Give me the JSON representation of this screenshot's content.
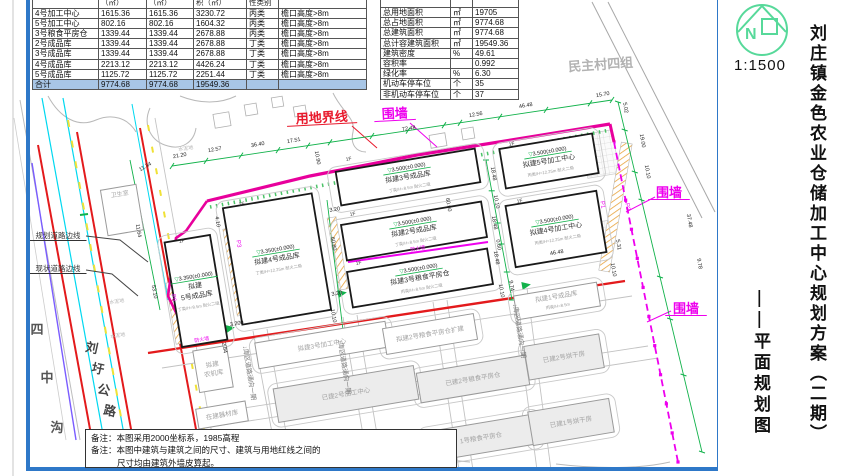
{
  "left_table": {
    "header_fragments": [
      "",
      "（㎡）",
      "（㎡）",
      "积（㎡）",
      "性类别",
      ""
    ],
    "col_widths": [
      66,
      48,
      47,
      53,
      32,
      88
    ],
    "rows": [
      {
        "name": "4号加工中心",
        "a1": "1615.36",
        "a2": "1615.36",
        "a3": "3230.72",
        "cls": "丙类",
        "note": "檐口高度>8m"
      },
      {
        "name": "5号加工中心",
        "a1": "802.16",
        "a2": "802.16",
        "a3": "1604.32",
        "cls": "丙类",
        "note": "檐口高度>8m"
      },
      {
        "name": "3号粮食平房仓",
        "a1": "1339.44",
        "a2": "1339.44",
        "a3": "2678.88",
        "cls": "丙类",
        "note": "檐口高度>8m"
      },
      {
        "name": "2号成品库",
        "a1": "1339.44",
        "a2": "1339.44",
        "a3": "2678.88",
        "cls": "丁类",
        "note": "檐口高度>8m"
      },
      {
        "name": "3号成品库",
        "a1": "1339.44",
        "a2": "1339.44",
        "a3": "2678.88",
        "cls": "丁类",
        "note": "檐口高度>8m"
      },
      {
        "name": "4号成品库",
        "a1": "2213.12",
        "a2": "2213.12",
        "a3": "4426.24",
        "cls": "丁类",
        "note": "檐口高度>8m"
      },
      {
        "name": "5号成品库",
        "a1": "1125.72",
        "a2": "1125.72",
        "a3": "2251.44",
        "cls": "丁类",
        "note": "檐口高度>8m"
      }
    ],
    "total": {
      "name": "合计",
      "a1": "9774.68",
      "a2": "9774.68",
      "a3": "19549.36",
      "cls": "",
      "note": ""
    }
  },
  "right_table": {
    "col_widths": [
      70,
      22,
      46
    ],
    "rows": [
      {
        "name": "总用地面积",
        "unit": "㎡",
        "value": "19705"
      },
      {
        "name": "总占地面积",
        "unit": "㎡",
        "value": "9774.68"
      },
      {
        "name": "总建筑面积",
        "unit": "㎡",
        "value": "9774.68"
      },
      {
        "name": "总计容建筑面积",
        "unit": "㎡",
        "value": "19549.36"
      },
      {
        "name": "建筑密度",
        "unit": "%",
        "value": "49.61"
      },
      {
        "name": "容积率",
        "unit": "",
        "value": "0.992"
      },
      {
        "name": "绿化率",
        "unit": "%",
        "value": "6.30"
      },
      {
        "name": "机动车停车位",
        "unit": "个",
        "value": "35"
      },
      {
        "name": "非机动车停车位",
        "unit": "个",
        "value": "37"
      }
    ]
  },
  "titleblock": {
    "title": "刘庄镇金色农业仓储加工中心规划方案（二期）",
    "subtitle": "——平面规划图",
    "scale": "1:1500",
    "compass_letter": "N"
  },
  "notes": {
    "line1": "备注：本图采用2000坐标系，1985高程",
    "line2": "备注：本图中建筑与建筑之间的尺寸、建筑与用地红线之间的",
    "line3": "尺寸均由建筑外墙皮算起。"
  },
  "map": {
    "colors": {
      "boundary": "#e8009c",
      "fence": "#ee00ee",
      "road_red": "#e31a1c",
      "road_cyan": "#00d8f0",
      "road_purple": "#7a5cff",
      "lane_yellow": "#f0e135",
      "dim_green": "#12b24b",
      "frame_blue": "#2e78c8",
      "hatch_orange": "#e8a33d"
    },
    "labels": [
      {
        "t": "用地界线",
        "x": 322,
        "y": 122,
        "s": 13,
        "c": "#e8192c",
        "r": -3,
        "ul": 1,
        "n": "site-boundary-label"
      },
      {
        "t": "围墙",
        "x": 395,
        "y": 118,
        "s": 13,
        "c": "#ee00ee",
        "r": -3,
        "ul": 1,
        "n": "fence-label-top"
      },
      {
        "t": "围墙",
        "x": 669,
        "y": 197,
        "s": 13,
        "c": "#ee00ee",
        "r": 0,
        "ul": 1,
        "n": "fence-label-east"
      },
      {
        "t": "围墙",
        "x": 686,
        "y": 313,
        "s": 13,
        "c": "#ee00ee",
        "r": 0,
        "ul": 1,
        "n": "fence-label-southeast"
      },
      {
        "t": "规划道路边线",
        "x": 58,
        "y": 238,
        "s": 7.5,
        "c": "#333333",
        "r": 0,
        "ul": 1,
        "n": "planned-road-edge-label"
      },
      {
        "t": "现状道路边线",
        "x": 58,
        "y": 271,
        "s": 7.5,
        "c": "#333333",
        "r": 0,
        "ul": 1,
        "n": "existing-road-edge-label"
      },
      {
        "t": "民主村四组",
        "x": 601,
        "y": 69,
        "s": 13,
        "c": "#b2b2b2",
        "r": -4,
        "n": "village-group-label"
      },
      {
        "t": "卫生室",
        "x": 120,
        "y": 196,
        "s": 6,
        "c": "#a8a8a8",
        "r": -9,
        "n": "clinic-label"
      },
      {
        "t": "水泥地",
        "x": 186,
        "y": 150,
        "s": 5,
        "c": "#b5b5b5",
        "r": -9,
        "n": "cement-ground-label"
      },
      {
        "t": "水泥地",
        "x": 117,
        "y": 303,
        "s": 5,
        "c": "#b5b5b5",
        "r": -9,
        "n": "cement-ground-label"
      },
      {
        "t": "水泥地",
        "x": 118,
        "y": 337,
        "s": 5,
        "c": "#b5b5b5",
        "r": -9,
        "n": "cement-ground-label"
      },
      {
        "t": "四",
        "x": 37,
        "y": 334,
        "s": 13,
        "c": "#555555",
        "r": 0,
        "n": "sizhonggou-char"
      },
      {
        "t": "中",
        "x": 47,
        "y": 382,
        "s": 13,
        "c": "#555555",
        "r": 0,
        "n": "sizhonggou-char"
      },
      {
        "t": "沟",
        "x": 57,
        "y": 432,
        "s": 13,
        "c": "#555555",
        "r": 0,
        "n": "sizhonggou-char"
      },
      {
        "t": "刘",
        "x": 91,
        "y": 352,
        "s": 12.5,
        "c": "#444444",
        "r": 12,
        "n": "liuwei-road-char"
      },
      {
        "t": "圩",
        "x": 97,
        "y": 373,
        "s": 12.5,
        "c": "#444444",
        "r": 12,
        "n": "liuwei-road-char"
      },
      {
        "t": "公",
        "x": 103,
        "y": 394,
        "s": 12.5,
        "c": "#444444",
        "r": 12,
        "n": "liuwei-road-char"
      },
      {
        "t": "路",
        "x": 109,
        "y": 415,
        "s": 12.5,
        "c": "#444444",
        "r": 12,
        "n": "liuwei-road-char"
      },
      {
        "t": "防火墙",
        "x": 418,
        "y": 250,
        "s": 5,
        "c": "#ee00ee",
        "r": -9.5,
        "n": "firewall-label"
      },
      {
        "t": "防火墙",
        "x": 202,
        "y": 341,
        "s": 5,
        "c": "#ee00ee",
        "r": -9.5,
        "n": "firewall-label"
      }
    ],
    "road_labels": [
      {
        "t": "↓库区道路通向一期",
        "x": 243,
        "y": 346,
        "n": "site-road-to-phase1-label"
      },
      {
        "t": "↓库区道路通向一期",
        "x": 338,
        "y": 340,
        "n": "site-road-to-phase1-label"
      },
      {
        "t": "↓库区道路通向一期",
        "x": 513,
        "y": 304,
        "n": "site-road-to-phase1-label"
      }
    ],
    "p_markers": [
      {
        "t": "P1",
        "x": 601,
        "y": 205
      },
      {
        "t": "P2",
        "x": 626,
        "y": 207
      },
      {
        "t": "P3",
        "x": 237,
        "y": 244
      },
      {
        "t": "P6",
        "x": 172,
        "y": 298
      }
    ],
    "floor_markers": [
      {
        "x": 346,
        "y": 161
      },
      {
        "x": 350,
        "y": 216
      },
      {
        "x": 356,
        "y": 265
      },
      {
        "x": 179,
        "y": 243
      },
      {
        "x": 239,
        "y": 206
      },
      {
        "x": 509,
        "y": 146
      },
      {
        "x": 517,
        "y": 203
      }
    ],
    "buildings": [
      {
        "name": "拟建3号成品库",
        "elev": "3.500(±0.000)",
        "sub": "丁类/H=8.5m 耐火二级",
        "x": 408,
        "y": 177,
        "w": 141,
        "h": 34,
        "r": -9.5,
        "kind": "new",
        "n": "building-finished-goods-3"
      },
      {
        "name": "拟建2号成品库",
        "elev": "3.500(±0.000)",
        "sub": "丁类/H=8.5m 耐火二级",
        "x": 414,
        "y": 231,
        "w": 142,
        "h": 36,
        "r": -9.5,
        "kind": "new",
        "n": "building-finished-goods-2"
      },
      {
        "name": "拟建3号粮食平房仓",
        "elev": "3.500(±0.000)",
        "sub": "丙类/H=8.5m 耐火二级",
        "x": 420,
        "y": 278,
        "w": 142,
        "h": 36,
        "r": -9.5,
        "kind": "new",
        "n": "building-grain-warehouse-3"
      },
      {
        "name": "拟建",
        "name2": "5号成品库",
        "elev": "3.350(±0.000)",
        "sub": "丁类/H=8.5m 耐火二级",
        "x": 196,
        "y": 291,
        "w": 46,
        "h": 106,
        "r": -9.5,
        "kind": "new",
        "n": "building-finished-goods-5"
      },
      {
        "name": "拟建4号成品库",
        "elev": "3.350(±0.000)",
        "sub": "丁类/H=12.25m 耐火二级",
        "x": 277,
        "y": 259,
        "w": 90,
        "h": 118,
        "r": -9.5,
        "kind": "new",
        "n": "building-finished-goods-4"
      },
      {
        "name": "拟建5号加工中心",
        "elev": "3.500(±0.000)",
        "sub": "丙类/H=12.25m 耐火二级",
        "x": 549,
        "y": 161,
        "w": 94,
        "h": 40,
        "r": -9.5,
        "kind": "new",
        "n": "building-processing-5"
      },
      {
        "name": "拟建4号加工中心",
        "elev": "3.500(±0.000)",
        "sub": "丙类/H=12.25m 耐火二级",
        "x": 556,
        "y": 229,
        "w": 92,
        "h": 62,
        "r": -9.5,
        "kind": "new",
        "n": "building-processing-4"
      },
      {
        "name": "拟建3号加工中心",
        "x": 322,
        "y": 345,
        "w": 132,
        "h": 26,
        "r": -9.5,
        "kind": "plan",
        "n": "building-processing-3"
      },
      {
        "name": "已建2号加工中心",
        "x": 346,
        "y": 394,
        "w": 142,
        "h": 34,
        "r": -9.5,
        "kind": "built",
        "n": "building-processing-2-built"
      },
      {
        "name": "拟建2号粮食平房仓扩建",
        "x": 430,
        "y": 334,
        "w": 92,
        "h": 26,
        "r": -9.5,
        "kind": "plan",
        "n": "building-grain-warehouse-2-ext"
      },
      {
        "name": "已建2号粮食平房仓",
        "x": 473,
        "y": 379,
        "w": 110,
        "h": 30,
        "r": -9.5,
        "kind": "built",
        "n": "building-grain-warehouse-2-built"
      },
      {
        "name": "1号粮食平房仓",
        "x": 481,
        "y": 438,
        "w": 112,
        "h": 30,
        "r": -9.5,
        "kind": "built",
        "n": "building-grain-warehouse-1"
      },
      {
        "name": "拟建1号成品库",
        "sub": "丙类/H=8.5m",
        "x": 557,
        "y": 301,
        "w": 84,
        "h": 24,
        "r": -9.5,
        "kind": "plan",
        "n": "building-finished-goods-1"
      },
      {
        "name": "已建2号烘干房",
        "x": 564,
        "y": 357,
        "w": 76,
        "h": 34,
        "r": -9.5,
        "kind": "built",
        "n": "building-dryer-2"
      },
      {
        "name": "已建1号烘干房",
        "x": 571,
        "y": 422,
        "w": 82,
        "h": 34,
        "r": -9.5,
        "kind": "built",
        "n": "building-dryer-1"
      },
      {
        "name": "拟建",
        "name2": "农机库",
        "x": 213,
        "y": 369,
        "w": 34,
        "h": 42,
        "r": -9.5,
        "kind": "plan",
        "n": "building-farm-machinery"
      },
      {
        "name": "在建器材库",
        "x": 222,
        "y": 415,
        "w": 50,
        "h": 20,
        "r": -9.5,
        "kind": "plan",
        "n": "building-equipment-store"
      },
      {
        "name": "",
        "x": 122,
        "y": 210,
        "w": 36,
        "h": 46,
        "r": -9.5,
        "kind": "plan",
        "n": "building-clinic"
      }
    ],
    "dims": [
      {
        "v": "21.20",
        "x": 180,
        "y": 157,
        "r": -10
      },
      {
        "v": "12.57",
        "x": 215,
        "y": 151,
        "r": -10
      },
      {
        "v": "36.40",
        "x": 258,
        "y": 146,
        "r": -10
      },
      {
        "v": "17.51",
        "x": 294,
        "y": 142,
        "r": -10
      },
      {
        "v": "10.90",
        "x": 316,
        "y": 158,
        "r": 80
      },
      {
        "v": "72.48",
        "x": 409,
        "y": 130,
        "r": -8
      },
      {
        "v": "12.56",
        "x": 476,
        "y": 116,
        "r": -10
      },
      {
        "v": "46.48",
        "x": 526,
        "y": 107,
        "r": -10
      },
      {
        "v": "15.70",
        "x": 603,
        "y": 96,
        "r": -10
      },
      {
        "v": "5.02",
        "x": 624,
        "y": 108,
        "r": 80
      },
      {
        "v": "19.00",
        "x": 641,
        "y": 141,
        "r": 80
      },
      {
        "v": "10.10",
        "x": 646,
        "y": 172,
        "r": 80
      },
      {
        "v": "37.48",
        "x": 688,
        "y": 221,
        "r": 80
      },
      {
        "v": "9.78",
        "x": 698,
        "y": 264,
        "r": 80
      },
      {
        "v": "5.31",
        "x": 617,
        "y": 245,
        "r": 80
      },
      {
        "v": "10.10",
        "x": 612,
        "y": 270,
        "r": 80
      },
      {
        "v": "46.48",
        "x": 557,
        "y": 254,
        "r": -10
      },
      {
        "v": "11.34",
        "x": 146,
        "y": 168,
        "r": -30
      },
      {
        "v": "11.64",
        "x": 137,
        "y": 231,
        "r": 80
      },
      {
        "v": "53.10",
        "x": 153,
        "y": 292,
        "r": 80
      },
      {
        "v": "2.84",
        "x": 223,
        "y": 348,
        "r": 80
      },
      {
        "v": "4.10",
        "x": 216,
        "y": 222,
        "r": 80
      },
      {
        "v": "60.80",
        "x": 332,
        "y": 244,
        "r": 80
      },
      {
        "v": "3.20",
        "x": 335,
        "y": 211,
        "r": -10
      },
      {
        "v": "3.20",
        "x": 337,
        "y": 295,
        "r": -10
      },
      {
        "v": "10.10",
        "x": 332,
        "y": 316,
        "r": 80
      },
      {
        "v": "3.200",
        "x": 237,
        "y": 325,
        "r": -10
      },
      {
        "v": "18.48",
        "x": 492,
        "y": 174,
        "r": 80
      },
      {
        "v": "10.10",
        "x": 495,
        "y": 202,
        "r": 80
      },
      {
        "v": "18.48",
        "x": 493,
        "y": 223,
        "r": 80
      },
      {
        "v": "0.60",
        "x": 497,
        "y": 245,
        "r": 80
      },
      {
        "v": "18.48",
        "x": 495,
        "y": 258,
        "r": 80
      },
      {
        "v": "10.10",
        "x": 500,
        "y": 291,
        "r": 80
      },
      {
        "v": "60.60",
        "x": 447,
        "y": 205,
        "r": 80
      },
      {
        "v": "9.74",
        "x": 510,
        "y": 286,
        "r": 80
      }
    ]
  }
}
